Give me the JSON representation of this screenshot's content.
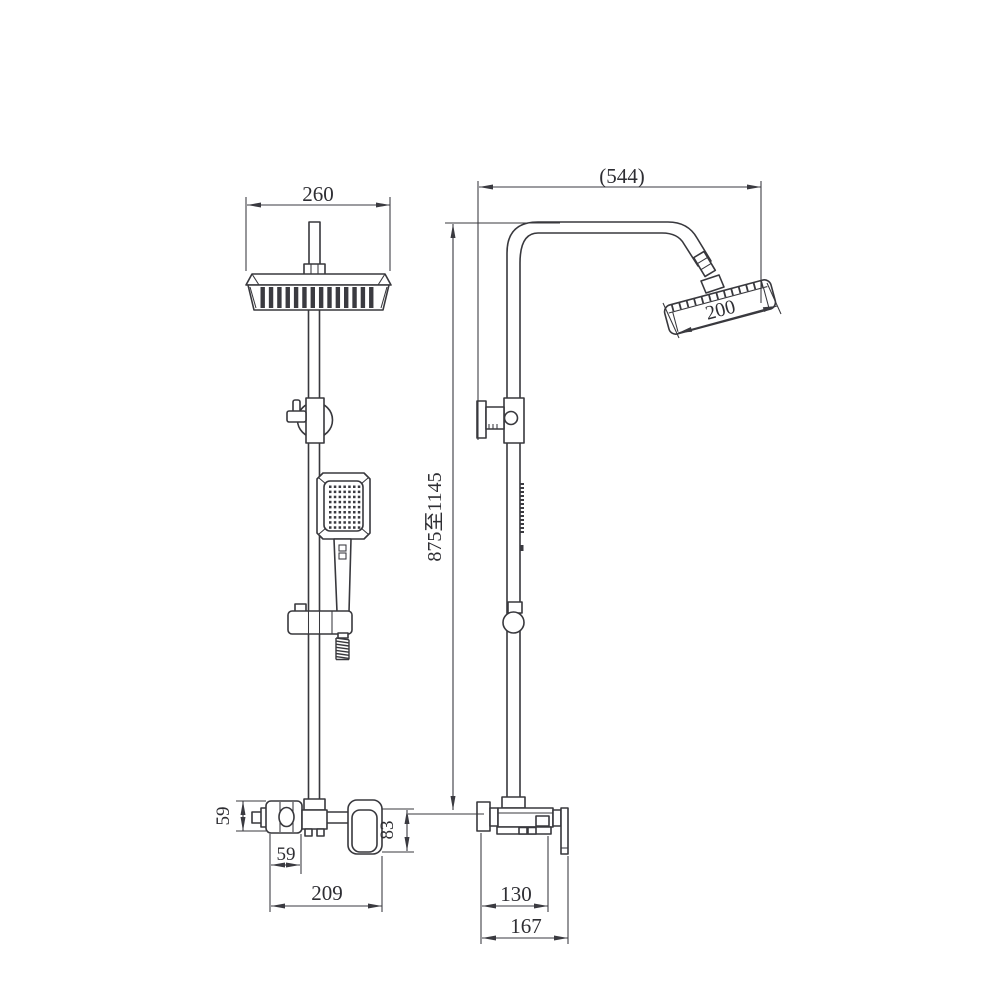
{
  "drawing": {
    "background_color": "#ffffff",
    "line_color": "#38383d",
    "views": [
      {
        "id": "front",
        "description": "front elevation of shower column"
      },
      {
        "id": "side",
        "description": "side elevation of shower column"
      }
    ],
    "dimensions": {
      "front": {
        "head_width": "260",
        "handle_plate_height": "59",
        "handle_plate_width": "59",
        "valve_body_height": "83",
        "valve_overall_width": "209"
      },
      "side": {
        "arm_reach": "(544)",
        "overhead_diameter": "200",
        "riser_height_range": "875至1145",
        "valve_body_depth": "130",
        "valve_overall_depth": "167"
      }
    }
  }
}
